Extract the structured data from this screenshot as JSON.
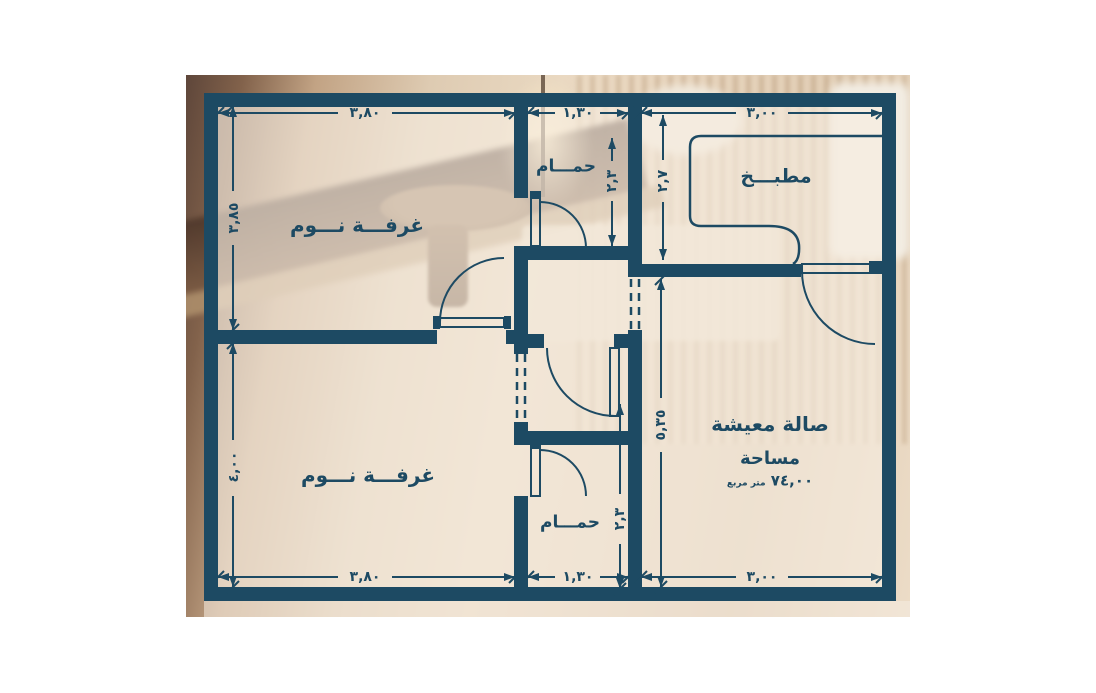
{
  "plan": {
    "colors": {
      "wall": "#1d4a63",
      "overlay": "#f3e9dc",
      "page": "#ffffff"
    },
    "rooms": {
      "bedroom_top": "غرفـــة نـــوم",
      "bedroom_bottom": "غرفـــة نـــوم",
      "bathroom_top": "حمـــام",
      "bathroom_bottom": "حمـــام",
      "kitchen": "مطبـــخ",
      "living": "صالة معيشة"
    },
    "area": {
      "label": "مساحة",
      "value": "٧٤,٠٠",
      "unit": "متر مربع"
    },
    "dims": {
      "top_bedroom_w": "٣,٨٠",
      "top_bath_w": "١,٣٠",
      "kitchen_w": "٣,٠٠",
      "bottom_bedroom_w": "٣,٨٠",
      "bottom_bath_w": "١,٣٠",
      "living_w": "٣,٠٠",
      "top_bedroom_h": "٣,٨٥",
      "bottom_bedroom_h": "٤,٠٠",
      "top_bath_h": "٢,٣",
      "bottom_bath_h": "٢,٣",
      "kitchen_h": "٢,٧",
      "living_h": "٥,٣٥"
    }
  }
}
